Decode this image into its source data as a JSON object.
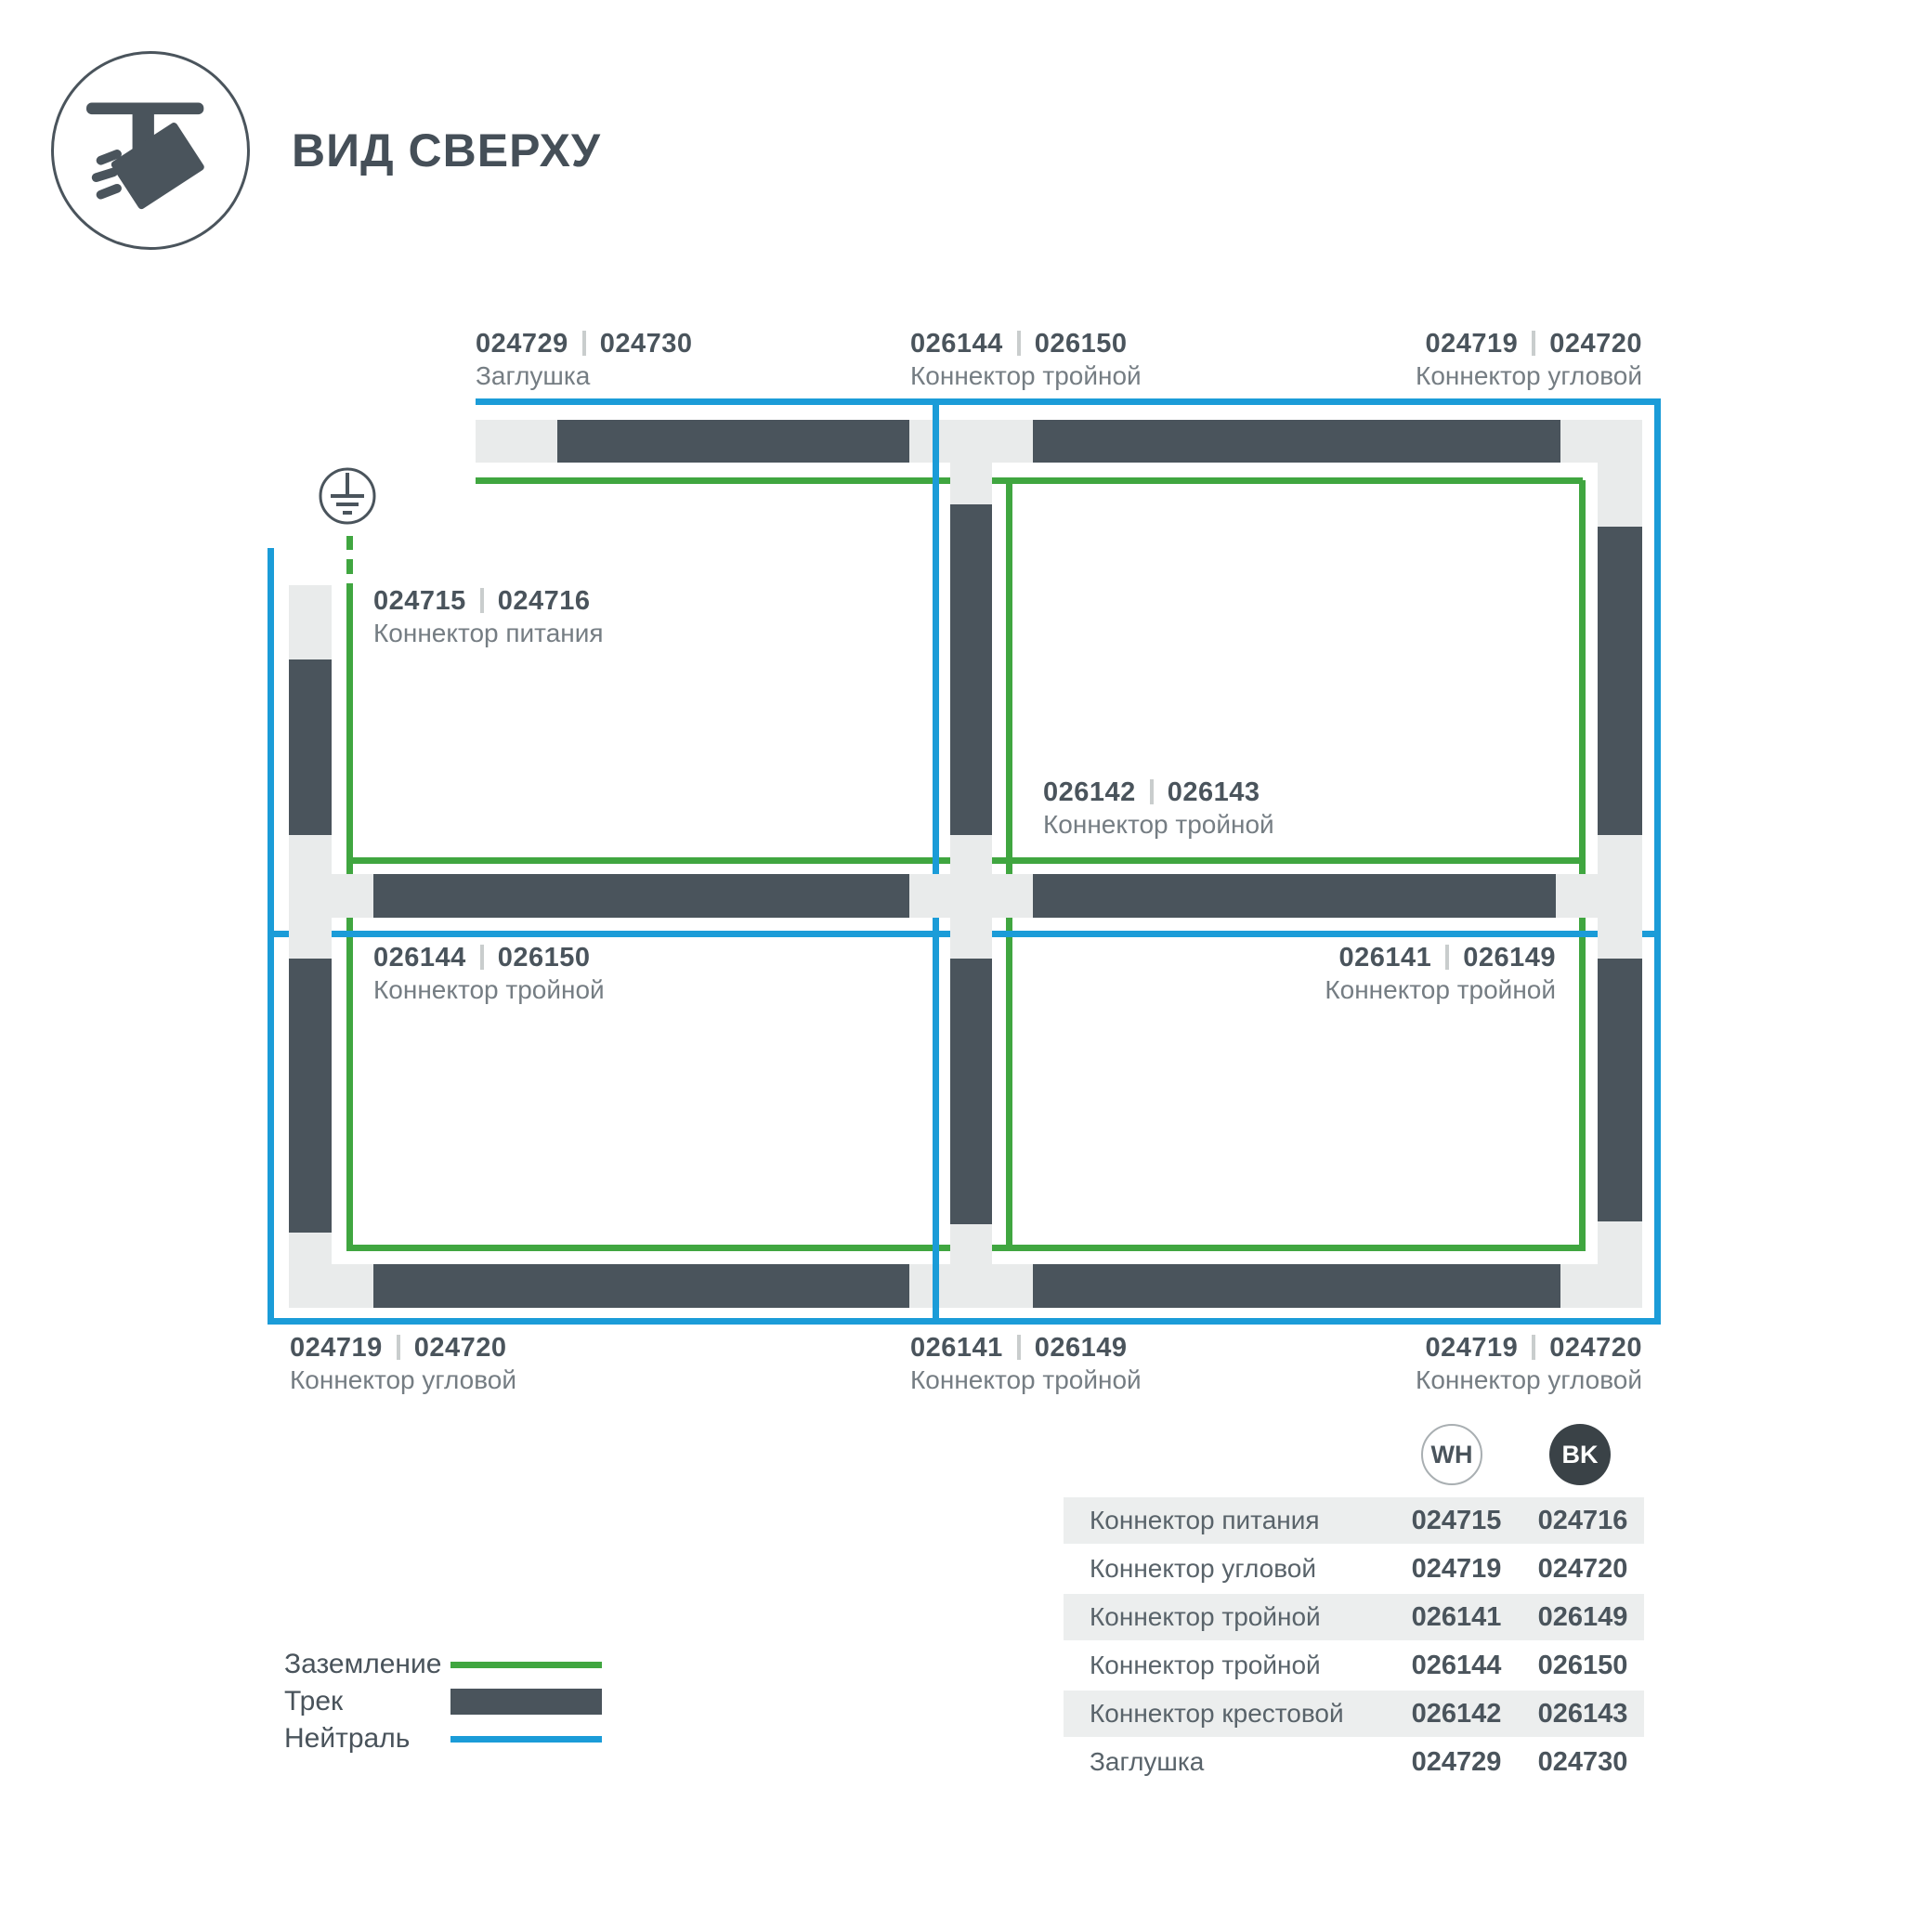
{
  "header": {
    "title": "ВИД СВЕРХУ"
  },
  "colors": {
    "track": "#4A545C",
    "ground": "#40A640",
    "neutral": "#1B9CD8",
    "connector": "#E9EBEB",
    "badge_black": "#3A4247",
    "table_row_alt": "#ECEEEE"
  },
  "diagram": {
    "labels": [
      {
        "code_left": "024729",
        "code_right": "024730",
        "name": "Заглушка"
      },
      {
        "code_left": "026144",
        "code_right": "026150",
        "name": "Коннектор тройной"
      },
      {
        "code_left": "024719",
        "code_right": "024720",
        "name": "Коннектор угловой"
      },
      {
        "code_left": "024715",
        "code_right": "024716",
        "name": "Коннектор питания"
      },
      {
        "code_left": "026142",
        "code_right": "026143",
        "name": "Коннектор тройной"
      },
      {
        "code_left": "026144",
        "code_right": "026150",
        "name": "Коннектор тройной"
      },
      {
        "code_left": "026141",
        "code_right": "026149",
        "name": "Коннектор тройной"
      },
      {
        "code_left": "024719",
        "code_right": "024720",
        "name": "Коннектор угловой"
      },
      {
        "code_left": "026141",
        "code_right": "026149",
        "name": "Коннектор тройной"
      },
      {
        "code_left": "024719",
        "code_right": "024720",
        "name": "Коннектор угловой"
      }
    ]
  },
  "legend": {
    "items": [
      {
        "label": "Заземление",
        "type": "ground-line"
      },
      {
        "label": "Трек",
        "type": "track"
      },
      {
        "label": "Нейтраль",
        "type": "neutral-line"
      }
    ]
  },
  "table": {
    "columns": [
      {
        "badge": "WH"
      },
      {
        "badge": "BK"
      }
    ],
    "rows": [
      {
        "name": "Коннектор питания",
        "wh": "024715",
        "bk": "024716"
      },
      {
        "name": "Коннектор угловой",
        "wh": "024719",
        "bk": "024720"
      },
      {
        "name": "Коннектор тройной",
        "wh": "026141",
        "bk": "026149"
      },
      {
        "name": "Коннектор тройной",
        "wh": "026144",
        "bk": "026150"
      },
      {
        "name": "Коннектор крестовой",
        "wh": "026142",
        "bk": "026143"
      },
      {
        "name": "Заглушка",
        "wh": "024729",
        "bk": "024730"
      }
    ]
  }
}
